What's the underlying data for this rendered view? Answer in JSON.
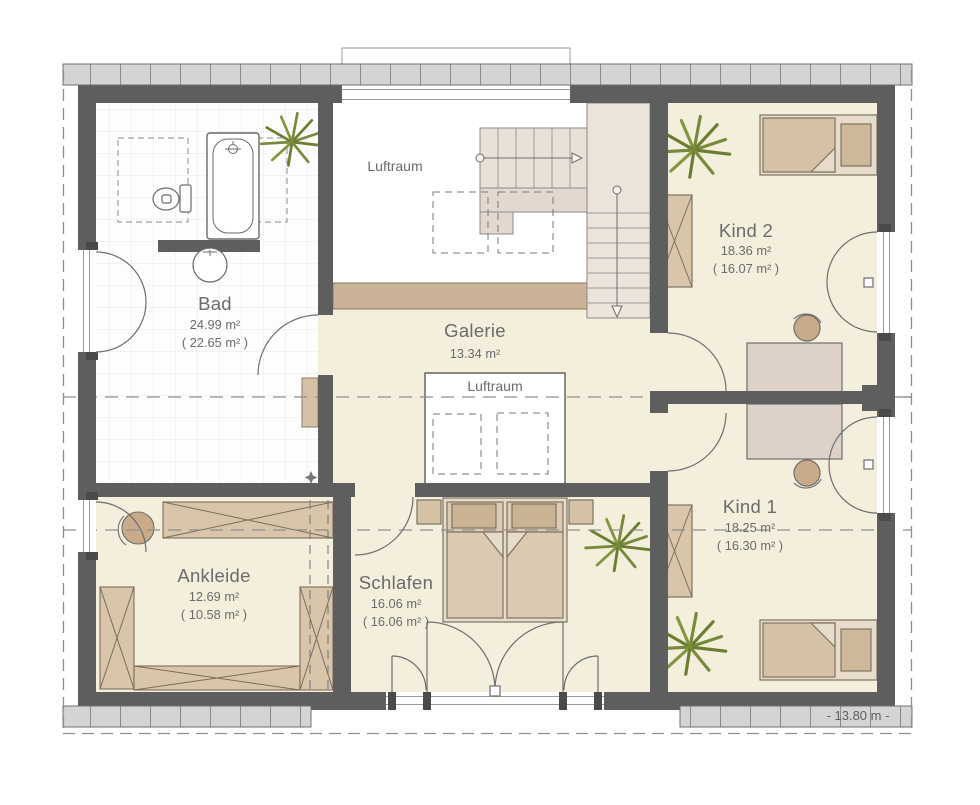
{
  "rooms": {
    "bad": {
      "name": "Bad",
      "area": "24.99 m²",
      "area_reduced": "( 22.65 m² )"
    },
    "galerie": {
      "name": "Galerie",
      "area": "13.34 m²"
    },
    "luftraum_top": {
      "name": "Luftraum"
    },
    "luftraum_void": {
      "name": "Luftraum"
    },
    "kind2": {
      "name": "Kind 2",
      "area": "18.36 m²",
      "area_reduced": "( 16.07 m² )"
    },
    "kind1": {
      "name": "Kind 1",
      "area": "18.25 m²",
      "area_reduced": "( 16.30 m² )"
    },
    "ankleide": {
      "name": "Ankleide",
      "area": "12.69 m²",
      "area_reduced": "( 10.58 m² )"
    },
    "schlafen": {
      "name": "Schlafen",
      "area": "16.06 m²",
      "area_reduced": "( 16.06 m² )"
    }
  },
  "dimension_label": "- 13.80 m -",
  "colors": {
    "wall": "#5e5e5e",
    "floor": "#f3efdc",
    "tile_floor": "#fdfdfd",
    "furniture": "#d5c1a6",
    "furniture_light": "#e7dccb",
    "gallery_edge": "#c9b296",
    "stair": "#ebe2da",
    "plant": "#77893a",
    "gutter_band": "#d4d4d4"
  }
}
